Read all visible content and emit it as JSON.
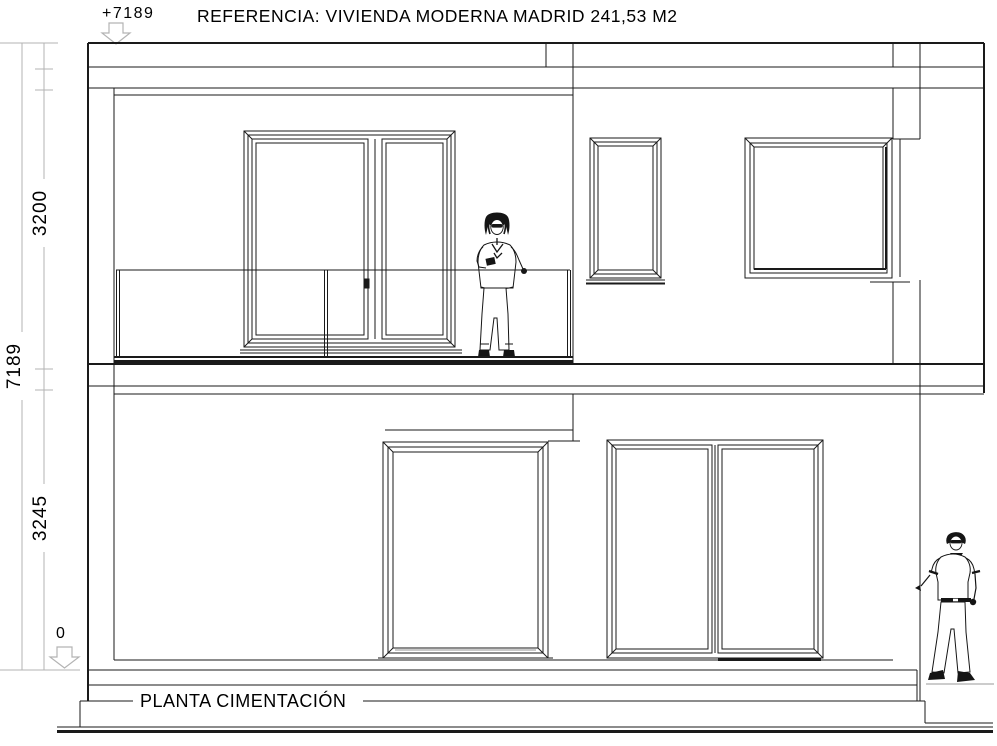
{
  "page": {
    "background": "#ffffff",
    "width": 997,
    "height": 746
  },
  "title": {
    "text": "REFERENCIA: VIVIENDA MODERNA MADRID 241,53 M2"
  },
  "levels": {
    "top": {
      "label": "+7189",
      "marker": "down-arrow"
    },
    "zero": {
      "label": "0",
      "marker": "down-arrow"
    }
  },
  "dimensions": {
    "upper_floor_height": "3200",
    "total_height": "7189",
    "ground_floor_height": "3245"
  },
  "caption": {
    "text": "PLANTA CIMENTACIÓN"
  },
  "figures": {
    "left": "woman-on-balcony",
    "right": "man-standing"
  },
  "colors": {
    "line": "#1a1a1a",
    "dimension_line": "#b3b3b3",
    "text": "#000000",
    "background": "#ffffff"
  }
}
